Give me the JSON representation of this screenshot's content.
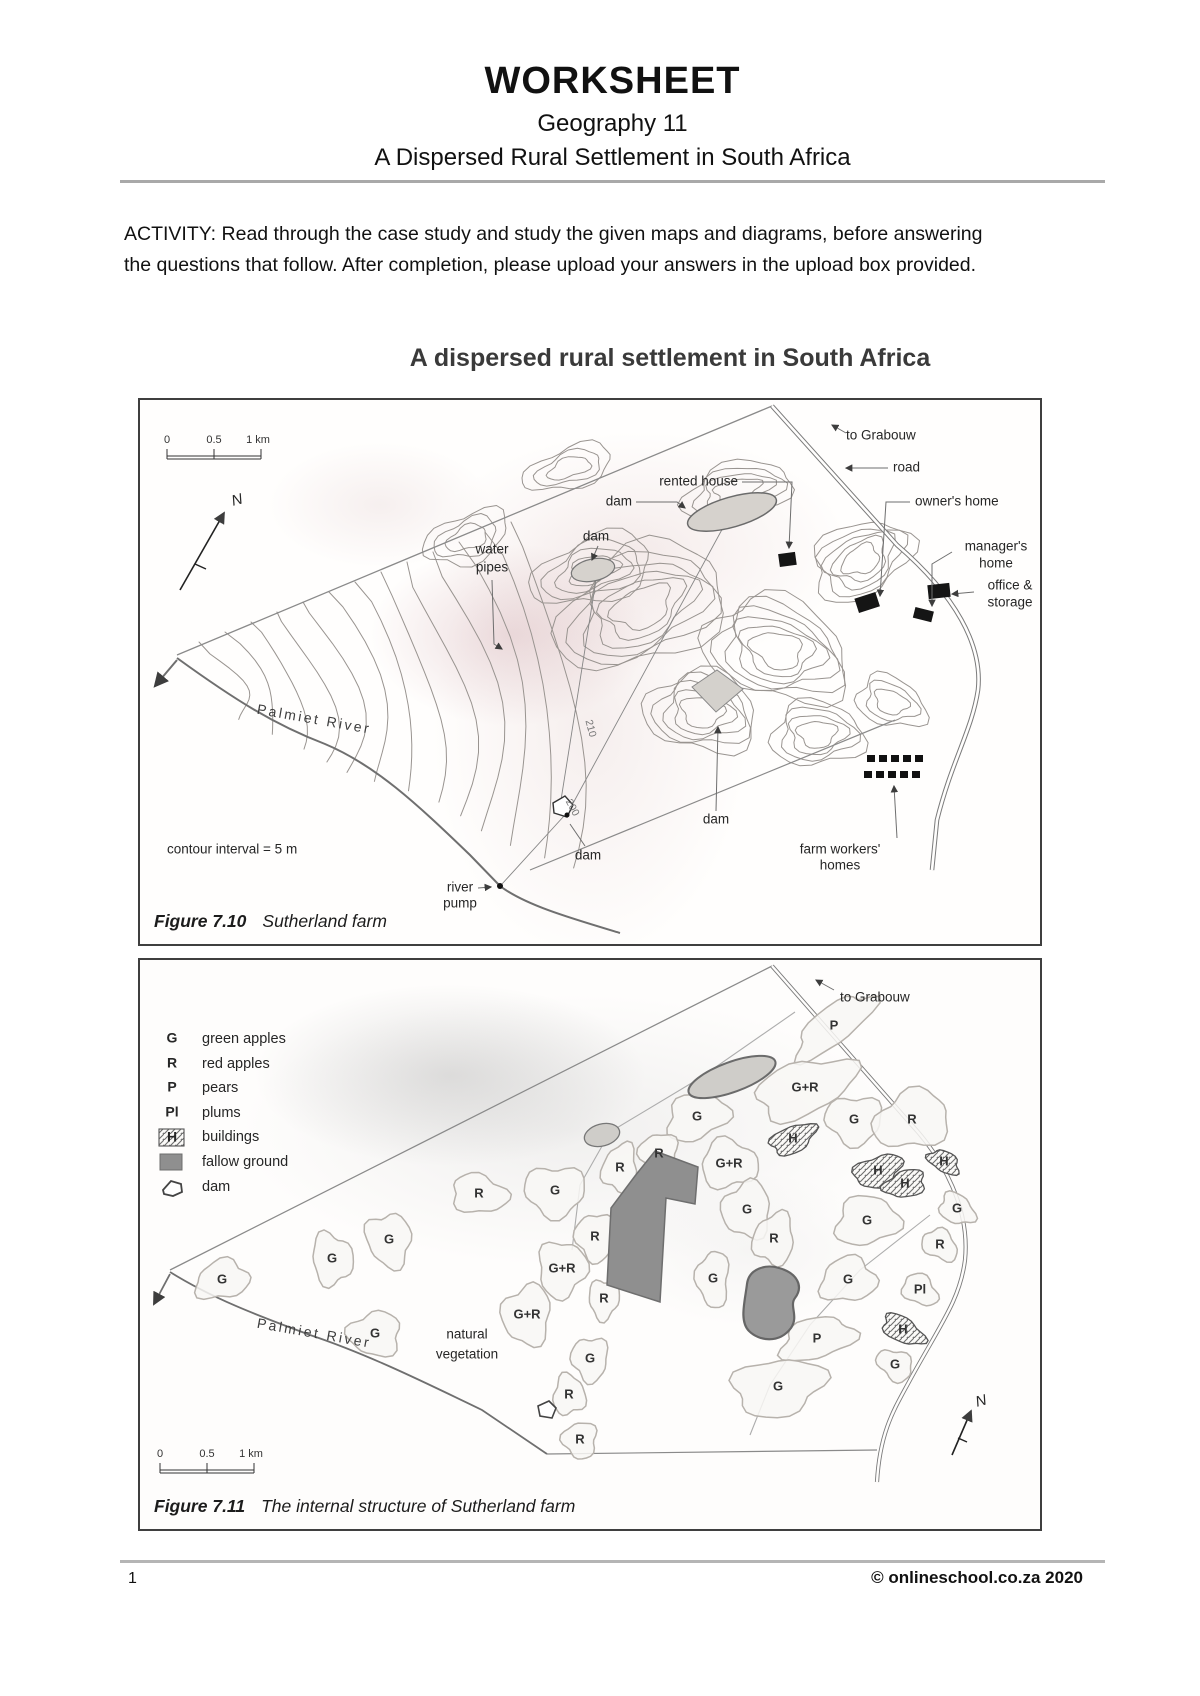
{
  "header": {
    "title": "WORKSHEET",
    "subtitle": "Geography 11",
    "topic": "A Dispersed Rural Settlement in South Africa"
  },
  "activity": {
    "text": "ACTIVITY: Read through the case study and study the given maps and diagrams, before answering the questions that follow. After completion, please upload your answers in the upload box provided."
  },
  "map_section": {
    "title": "A dispersed rural settlement in South Africa"
  },
  "figure_710": {
    "caption_label": "Figure 7.10",
    "caption_text": "Sutherland farm",
    "scale": {
      "zero": "0",
      "half": "0.5",
      "one": "1 km"
    },
    "north": "N",
    "contour_note": "contour interval = 5 m",
    "labels": {
      "to_grabouw": "to Grabouw",
      "road": "road",
      "rented_house": "rented house",
      "dam_top": "dam",
      "dam_mid": "dam",
      "water_pipes_1": "water",
      "water_pipes_2": "pipes",
      "owners_home": "owner's home",
      "managers_home_1": "manager's",
      "managers_home_2": "home",
      "office_storage_1": "office &",
      "office_storage_2": "storage",
      "palmiet_river": "Palmiet River",
      "river_pump_1": "river",
      "river_pump_2": "pump",
      "dam_bottom": "dam",
      "dam_right": "dam",
      "farm_workers_1": "farm workers'",
      "farm_workers_2": "homes",
      "contour_210": "210",
      "contour_200": "200"
    }
  },
  "figure_711": {
    "caption_label": "Figure 7.11",
    "caption_text": "The internal structure of Sutherland farm",
    "scale": {
      "zero": "0",
      "half": "0.5",
      "one": "1 km"
    },
    "north": "N",
    "legend": [
      {
        "symbol": "G",
        "label": "green apples"
      },
      {
        "symbol": "R",
        "label": "red apples"
      },
      {
        "symbol": "P",
        "label": "pears"
      },
      {
        "symbol": "Pl",
        "label": "plums"
      },
      {
        "symbol": "H",
        "label": "buildings"
      },
      {
        "symbol": "",
        "label": "fallow ground"
      },
      {
        "symbol": "",
        "label": "dam"
      }
    ],
    "labels": {
      "to_grabouw": "to Grabouw",
      "palmiet_river": "Palmiet River",
      "natural_vegetation_1": "natural",
      "natural_vegetation_2": "vegetation"
    },
    "parcels": [
      "P",
      "G+R",
      "G",
      "R",
      "G",
      "H",
      "R",
      "R",
      "G+R",
      "H",
      "H",
      "H",
      "R",
      "G",
      "G",
      "G",
      "G",
      "R",
      "R",
      "R",
      "G+R",
      "G",
      "G",
      "Pl",
      "R",
      "G+R",
      "P",
      "H",
      "G",
      "G",
      "R",
      "G",
      "R",
      "G",
      "G",
      "G",
      "G"
    ]
  },
  "footer": {
    "page_number": "1",
    "copyright": "© onlineschool.co.za 2020"
  }
}
